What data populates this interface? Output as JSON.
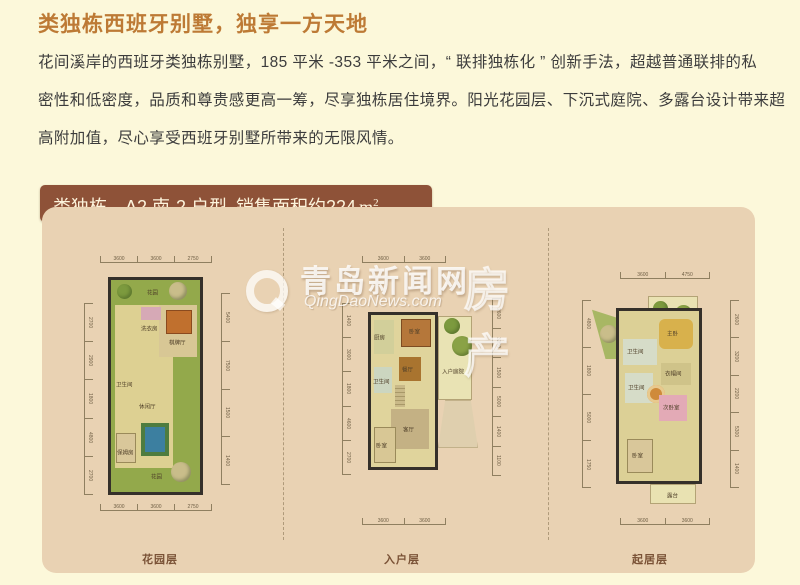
{
  "page_title": "类独栋西班牙别墅，独享一方天地",
  "intro": {
    "lines": [
      "花间溪岸的西班牙类独栋别墅，185 平米 -353 平米之间，“ 联排独栋化 ” 创新手法，超越普通联排的私",
      "密性和低密度，品质和尊贵感更高一筹，尽享独栋居住境界。阳光花园层、下沉式庭院、多露台设计带来超",
      "高附加值，尽心享受西班牙别墅所带来的无限风情。"
    ]
  },
  "badge": {
    "type_label": "类独栋",
    "separator": "·",
    "unit_name": "A2 南-2 户型",
    "area_label": "销售面积约",
    "area_value": "224",
    "area_unit": "m",
    "area_sup": "2"
  },
  "watermark": {
    "cn": "青岛新闻网",
    "en": "QingDaoNews.com",
    "right": "房产"
  },
  "colors": {
    "page_bg": "#fcf8da",
    "panel_bg": "#e9d2b3",
    "badge_bg": "#8e5238",
    "title_text": "#bd7a35",
    "garden_green": "#93a94b",
    "floor_yellow": "#ddd092",
    "pool_blue": "#3c7fa0",
    "wall_dark": "#35302a"
  },
  "floorplans": [
    {
      "label": "花园层",
      "rooms": {
        "garden_top": "花园",
        "laundry": "洗衣房",
        "game": "棋牌厅",
        "bath": "卫生间",
        "lounge": "休闲厅",
        "maid": "保姆房",
        "garden_bottom": "花园"
      },
      "dims_top": [
        "3600",
        "3600",
        "2750"
      ],
      "dims_bottom": [
        "3600",
        "3600",
        "2750"
      ],
      "dims_left": [
        "2700",
        "2900",
        "1800",
        "4800",
        "2700"
      ],
      "dims_right": [
        "5400",
        "7500",
        "1500",
        "1400"
      ]
    },
    {
      "label": "入户层",
      "rooms": {
        "bedroom_top": "卧室",
        "kitchen": "厨房",
        "dining": "餐厅",
        "courtyard": "入户庭院",
        "bath": "卫生间",
        "living": "客厅",
        "bedroom_bottom": "卧室"
      },
      "dims_top": [
        "3600",
        "3600"
      ],
      "dims_bottom": [
        "3600",
        "3600"
      ],
      "dims_left": [
        "1400",
        "3000",
        "1800",
        "4600",
        "2700"
      ],
      "dims_right": [
        "2600",
        "3200",
        "1500",
        "5000",
        "1400",
        "1100"
      ]
    },
    {
      "label": "起居层",
      "rooms": {
        "terrace_top": "露台",
        "master": "主卧",
        "bath1": "卫生间",
        "cloak": "衣帽间",
        "bath2": "卫生间",
        "second": "次卧室",
        "bedroom": "卧室",
        "terrace_bottom": "露台"
      },
      "dims_top": [
        "3600",
        "4750"
      ],
      "dims_bottom": [
        "3600",
        "3600"
      ],
      "dims_left": [
        "4800",
        "1800",
        "5000",
        "1750"
      ],
      "dims_right": [
        "2600",
        "3200",
        "2200",
        "5300",
        "1400"
      ]
    }
  ]
}
